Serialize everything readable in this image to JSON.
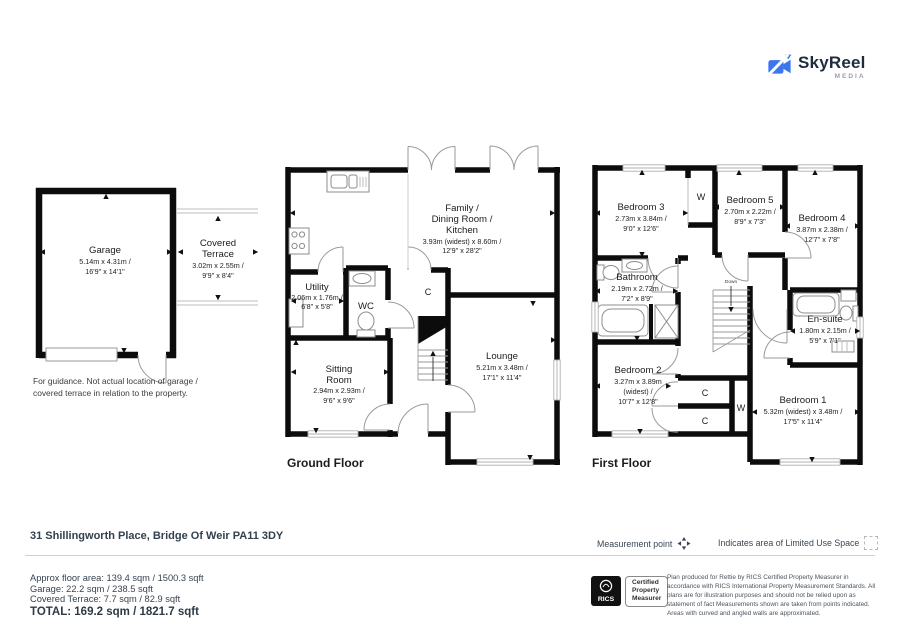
{
  "logo": {
    "title": "SkyReel",
    "subtitle": "MEDIA"
  },
  "icons": {
    "logo": "video-camera",
    "measurement_point": "four-direction-arrow",
    "limited_use": "dashed-square",
    "rics": "rics-crest"
  },
  "colors": {
    "brand_blue": "#3b76f0",
    "wall": "#0c0c0c",
    "footer_text": "#33404e"
  },
  "garage_block": {
    "garage_name": "Garage",
    "garage_dims_m": "5.14m x 4.31m /",
    "garage_dims_ft": "16'9\" x 14'1\"",
    "terrace_name_1": "Covered",
    "terrace_name_2": "Terrace",
    "terrace_dims_m": "3.02m x 2.55m /",
    "terrace_dims_ft": "9'9\" x 8'4\"",
    "guidance_1": "For guidance. Not actual location of garage /",
    "guidance_2": "covered terrace in relation to the property."
  },
  "ground_floor": {
    "label": "Ground Floor",
    "family_1": "Family /",
    "family_2": "Dining Room /",
    "family_3": "Kitchen",
    "family_dims_m": "3.93m (widest) x 8.60m /",
    "family_dims_ft": "12'9\" x 28'2\"",
    "utility_name": "Utility",
    "utility_dims_m": "2.06m x 1.76m /",
    "utility_dims_ft": "6'8\" x 5'8\"",
    "wc": "WC",
    "closet": "C",
    "sitting_1": "Sitting",
    "sitting_2": "Room",
    "sitting_dims_m": "2.94m x 2.93m /",
    "sitting_dims_ft": "9'6\" x 9'6\"",
    "lounge_name": "Lounge",
    "lounge_dims_m": "5.21m x 3.48m /",
    "lounge_dims_ft": "17'1\" x 11'4\""
  },
  "first_floor": {
    "label": "First Floor",
    "down": "Down",
    "closet": "C",
    "wardrobe": "W",
    "bedroom3_name": "Bedroom 3",
    "bedroom3_dims_m": "2.73m x 3.84m /",
    "bedroom3_dims_ft": "9'0\" x 12'6\"",
    "bedroom5_name": "Bedroom 5",
    "bedroom5_dims_m": "2.70m x 2.22m /",
    "bedroom5_dims_ft": "8'9\" x 7'3\"",
    "bedroom4_name": "Bedroom 4",
    "bedroom4_dims_m": "3.87m x 2.38m /",
    "bedroom4_dims_ft": "12'7\" x 7'8\"",
    "bathroom_name": "Bathroom",
    "bathroom_dims_m": "2.19m x 2.72m /",
    "bathroom_dims_ft": "7'2\" x 8'9\"",
    "ensuite_name": "En-suite",
    "ensuite_dims_m": "1.80m x 2.15m /",
    "ensuite_dims_ft": "5'9\" x 7'1\"",
    "bedroom2_name": "Bedroom 2",
    "bedroom2_dims_m1": "3.27m x 3.89m",
    "bedroom2_dims_m2": "(widest) /",
    "bedroom2_dims_ft": "10'7\" x 12'8\"",
    "bedroom1_name": "Bedroom 1",
    "bedroom1_dims_m": "5.32m (widest) x 3.48m /",
    "bedroom1_dims_ft": "17'5\" x 11'4\""
  },
  "footer": {
    "address": "31 Shillingworth Place, Bridge Of Weir PA11 3DY",
    "measurement_label": "Measurement point",
    "limited_use_label": "Indicates area of  Limited Use Space",
    "area_line_1": "Approx floor area: 139.4 sqm / 1500.3 sqft",
    "area_line_2": "Garage: 22.2 sqm / 238.5 sqft",
    "area_line_3": "Covered Terrace: 7.7 sqm / 82.9 sqft",
    "area_total": "TOTAL: 169.2 sqm / 1821.7 sqft",
    "rics_name": "RICS",
    "rics_cert_1": "Certified",
    "rics_cert_2": "Property",
    "rics_cert_3": "Measurer",
    "disclaimer": "Plan produced for Rettie by RICS Certified Property Measurer in accordance with RICS International Property  Measurement Standards.  All plans are for illustration purposes and should not be relied upon as statement of fact Measurements shown are taken from points indicated. Areas with curved and angled walls are approximated."
  }
}
